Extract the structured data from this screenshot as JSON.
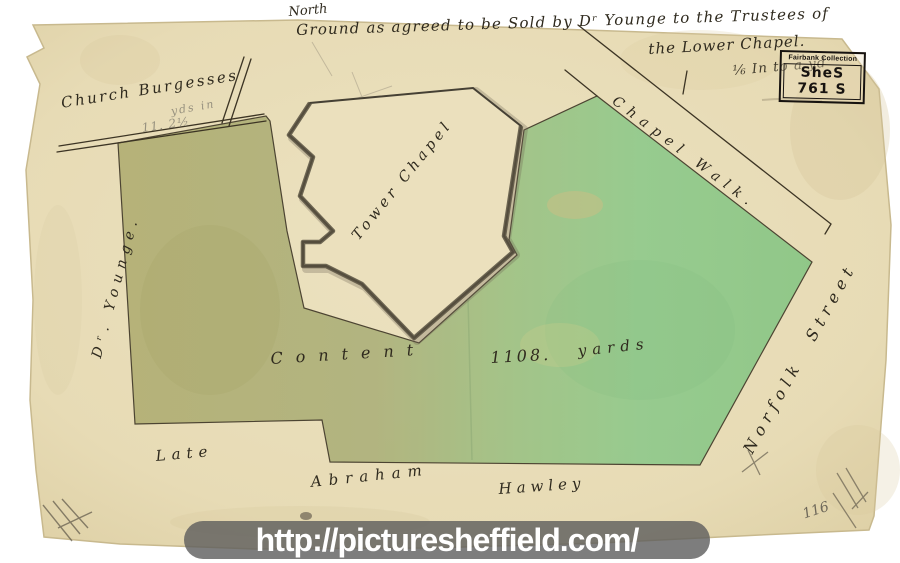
{
  "colors": {
    "paper": "#e8ddb8",
    "olive_parcel": "#b2ae72",
    "green_parcel": "#8cc98a",
    "ink": "#2f2a1e",
    "watermark_bar": "#5c5c5c"
  },
  "watermark": {
    "url": "http://picturesheffield.com/"
  },
  "stamp": {
    "collection": "Fairbank Collection",
    "reference": "SheS 761 S"
  },
  "labels": {
    "north": "North",
    "title_line1": "Ground as agreed to be Sold by Dʳ Younge to the Trustees of",
    "title_line2": "the Lower Chapel.",
    "scale_note": "⅙ In to a yd",
    "church_burgesses": "Church Burgesses",
    "pencil_yds": "yds  in",
    "pencil_area": "11. 2½",
    "dr_younge": "Dʳ. Younge.",
    "tower_chapel": "Tower Chapel",
    "chapel_walk": "Chapel Walk.",
    "norfolk_street": "Norfolk Street",
    "content_word": "Content",
    "content_value": "1108.",
    "content_unit": "yards",
    "late": "Late",
    "abraham": "Abraham",
    "hawley": "Hawley",
    "pencil_ref": "116"
  }
}
